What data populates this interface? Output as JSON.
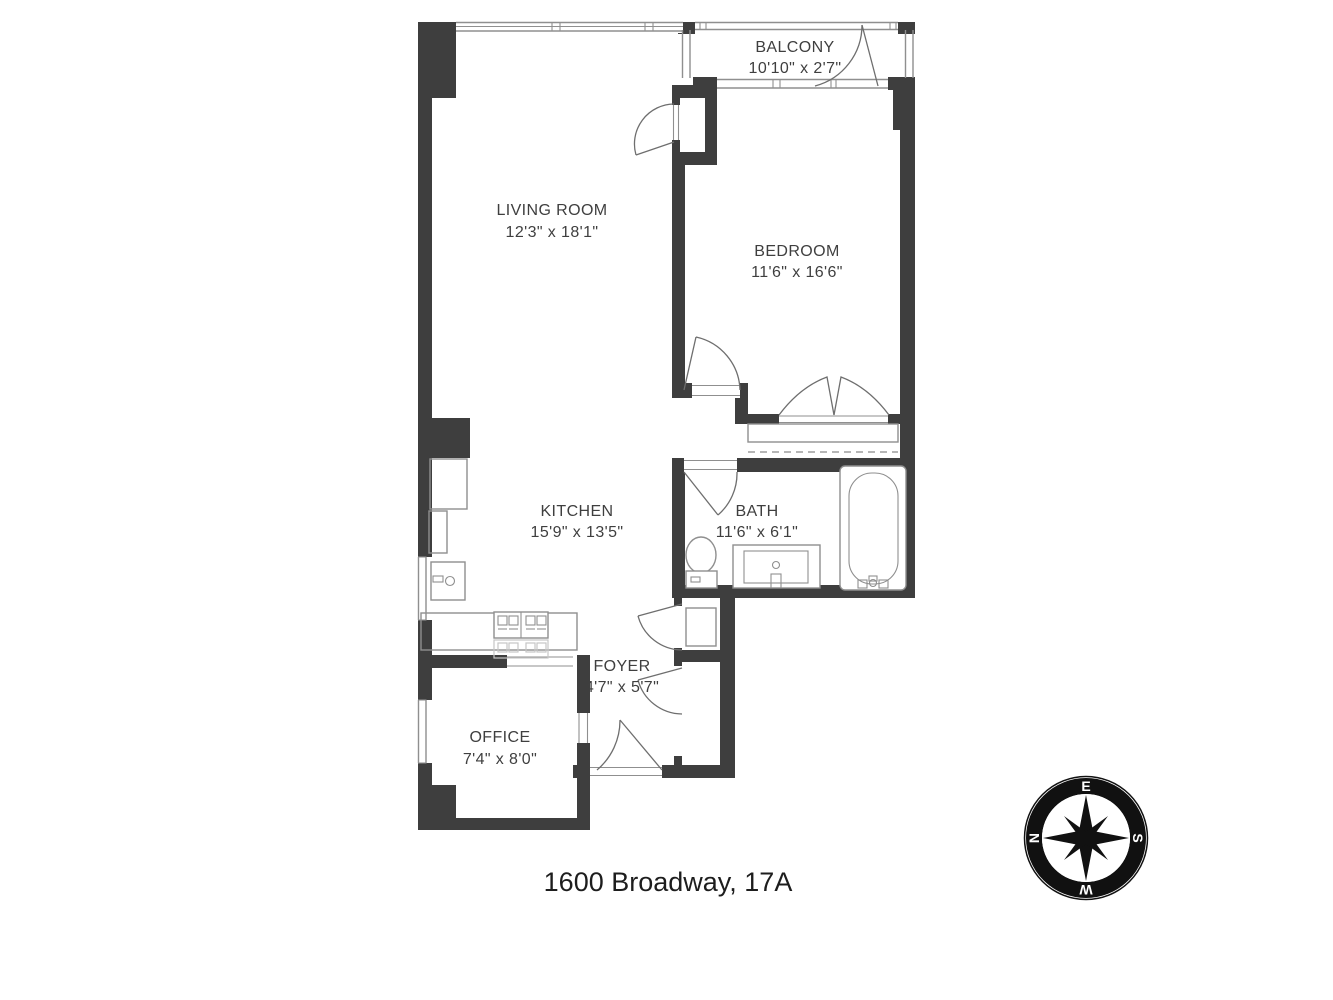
{
  "title": "1600 Broadway, 17A",
  "rooms": {
    "balcony": {
      "name": "BALCONY",
      "dims": "10'10\" x 2'7\""
    },
    "living": {
      "name": "LIVING ROOM",
      "dims": "12'3\" x 18'1\""
    },
    "bedroom": {
      "name": "BEDROOM",
      "dims": "11'6\" x 16'6\""
    },
    "kitchen": {
      "name": "KITCHEN",
      "dims": "15'9\" x 13'5\""
    },
    "bath": {
      "name": "BATH",
      "dims": "11'6\" x 6'1\""
    },
    "foyer": {
      "name": "FOYER",
      "dims": "4'7\" x 5'7\""
    },
    "office": {
      "name": "OFFICE",
      "dims": "7'4\" x 8'0\""
    }
  },
  "compass": {
    "top": "E",
    "right": "S",
    "bottom": "W",
    "left": "N"
  },
  "colors": {
    "wall": "#3e3e3e",
    "fixture_line": "#8f8f8f",
    "text": "#3f3f3f"
  }
}
